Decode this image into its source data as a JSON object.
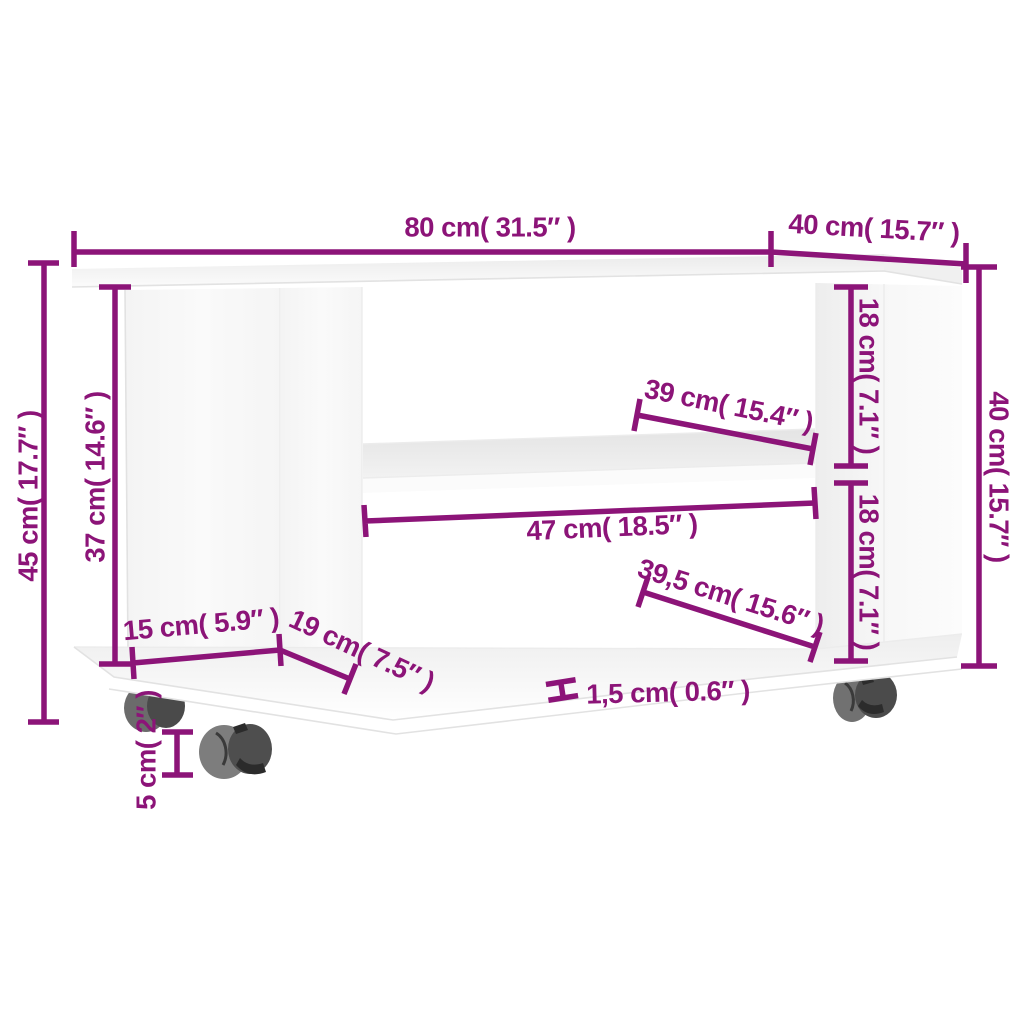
{
  "image": {
    "kind": "product-dimension-diagram",
    "product": "TV stand with casters",
    "background_color": "#ffffff"
  },
  "colors": {
    "dimension_accent": "#8c1478",
    "panel_white": "#f8f8f8",
    "compartment_white": "#ffffff",
    "shelf_gray": "#e8e8e8",
    "caster_front_gray": "#7d7d7d",
    "caster_back_gray": "#4e4e4e",
    "caster_slot_dark": "#2c2c2c"
  },
  "dimensions": {
    "top_width": {
      "label": "80 cm( 31.5″ )"
    },
    "top_depth": {
      "label": "40 cm( 15.7″ )"
    },
    "overall_height": {
      "label": "45 cm( 17.7″ )"
    },
    "inner_height": {
      "label": "37 cm( 14.6″ )"
    },
    "shelf_depth": {
      "label": "39 cm( 15.4″ )"
    },
    "upper_compartment_height": {
      "label": "18 cm( 7.1″ )"
    },
    "lower_compartment_height": {
      "label": "18 cm( 7.1″ )"
    },
    "right_height": {
      "label": "40 cm( 15.7″ )"
    },
    "shelf_width": {
      "label": "47 cm( 18.5″ )"
    },
    "bottom_shelf_width": {
      "label": "39,5 cm( 15.6″ )"
    },
    "left_section_width": {
      "label": "15 cm( 5.9″ )"
    },
    "left_section_depth": {
      "label": "19 cm( 7.5″ )"
    },
    "board_thickness": {
      "label": "1,5 cm( 0.6″ )"
    },
    "caster_height": {
      "label": "5 cm( 2″ )"
    }
  }
}
